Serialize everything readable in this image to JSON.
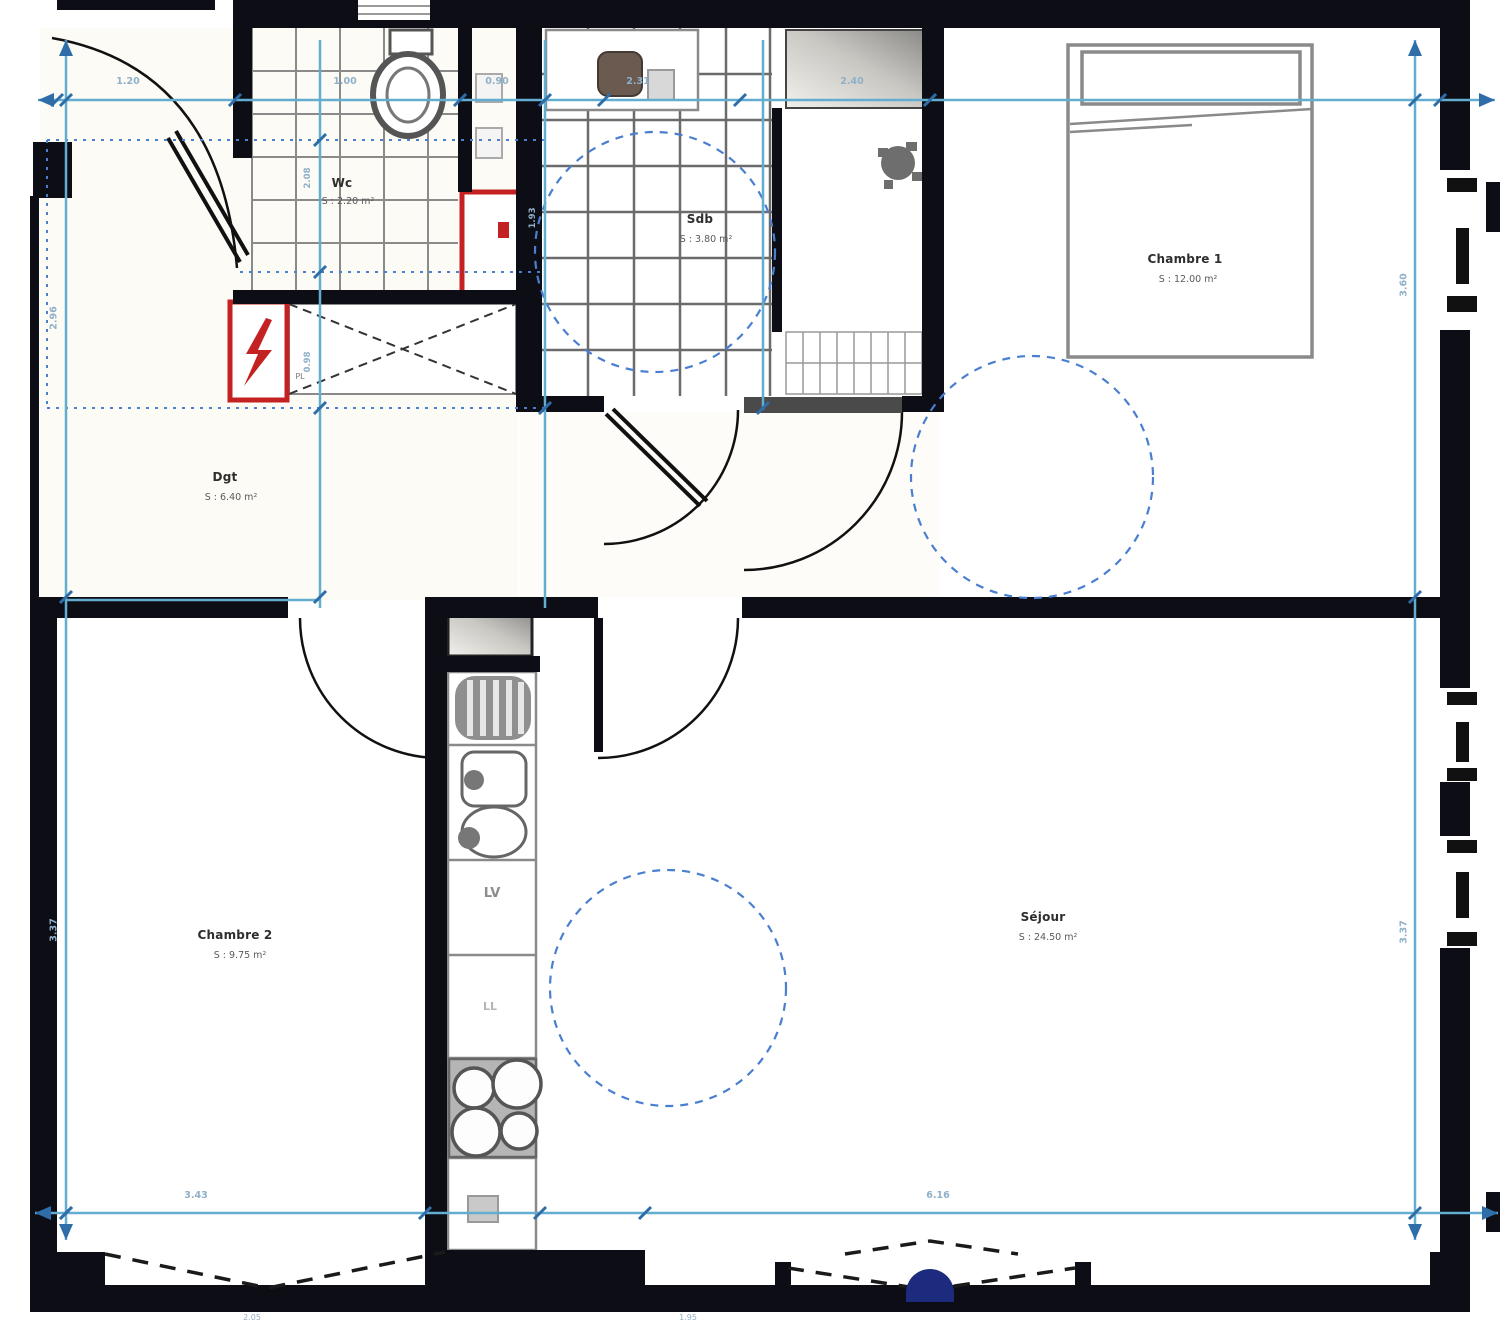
{
  "rooms": {
    "wc": {
      "name": "Wc",
      "area": "S : 2.20 m²"
    },
    "sdb": {
      "name": "Sdb",
      "area": "S : 3.80 m²"
    },
    "dgt": {
      "name": "Dgt",
      "area": "S : 6.40 m²"
    },
    "ch1": {
      "name": "Chambre 1",
      "area": "S : 12.00 m²"
    },
    "ch2": {
      "name": "Chambre 2",
      "area": "S : 9.75 m²"
    },
    "sejour": {
      "name": "Séjour",
      "area": "S : 24.50 m²"
    }
  },
  "labels": {
    "lv": "LV",
    "ll": "LL",
    "pl": "PL"
  },
  "dims": {
    "top": {
      "d1": "1.20",
      "d2": "1.00",
      "d3": "0.90",
      "d4": "2.31",
      "d5": "2.40"
    },
    "bottom": {
      "d1": "3.43",
      "d2": "6.16"
    },
    "left": {
      "upper": "2.96",
      "lower": "3.37"
    },
    "right": {
      "upper": "3.60",
      "lower": "3.37"
    },
    "inner": {
      "i1": "2.08",
      "i2": "0.98",
      "i3": "1.93"
    },
    "cut": {
      "c1": "2.05",
      "c2": "1.95"
    }
  },
  "colors": {
    "wall": "#0d0d15",
    "dimension_line": "#63aed0",
    "dimension_tick": "#2e6da8",
    "dimension_text": "#8fb0c9",
    "turning_circle": "#4a7fd0",
    "accent_red": "#c42222",
    "bay_dome_blue": "#1c2b7e",
    "tile_grid": "#6b6b6b"
  }
}
